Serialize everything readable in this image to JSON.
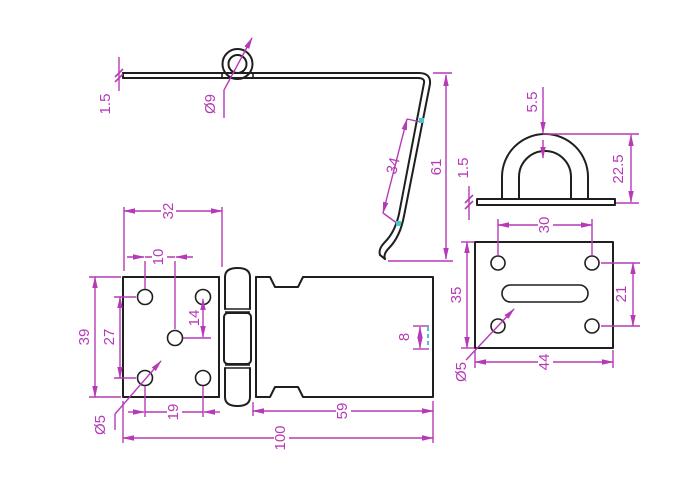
{
  "drawing": {
    "background_color": "#ffffff",
    "outline_color": "#1f1f1f",
    "dimension_color": "#b63ab6",
    "highlight_color": "#4ac4cd",
    "views": {
      "hasp_side": {
        "dims": {
          "plate_thickness": "1.5",
          "ring_diameter": "Ø9",
          "bend_length": "34",
          "bend_drop": "61"
        }
      },
      "staple_side": {
        "dims": {
          "wire_width": "5.5",
          "plate_thickness": "1.5",
          "loop_height": "22.5"
        }
      },
      "hasp_front": {
        "dims": {
          "hinge_offset": "32",
          "hole_pitch_x": "10",
          "hole_pitch_y": "14",
          "hole_rows_spacing": "27",
          "plate_width": "39",
          "bottom_hole_pitch": "19",
          "hole_diameter": "Ø5",
          "edge_slot_width": "8",
          "strap_length": "59",
          "overall_length": "100"
        }
      },
      "staple_front": {
        "dims": {
          "hole_pitch_x": "30",
          "plate_height": "35",
          "hole_pitch_y": "21",
          "plate_length": "44",
          "hole_diameter": "Ø5"
        }
      }
    }
  }
}
